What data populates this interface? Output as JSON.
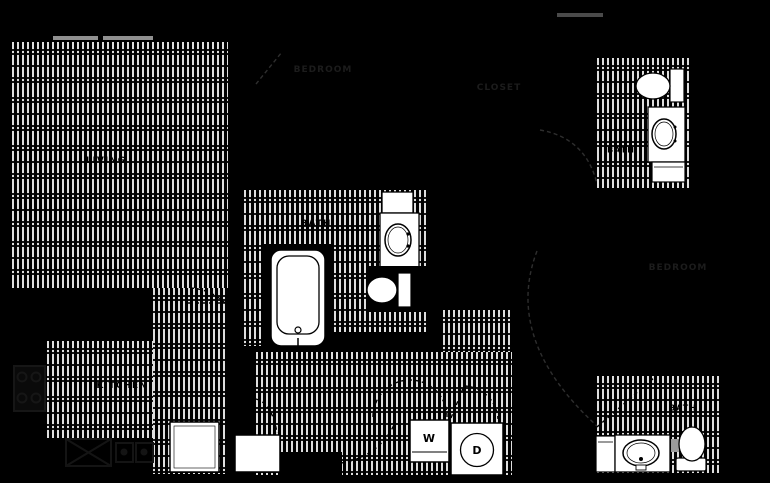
{
  "plan": {
    "title": "floor-plan",
    "rooms": {
      "living": "LIVING",
      "kitchen": "KITCHEN",
      "bath_main": "BATH",
      "bath_upper_right": "BATH",
      "bath_lower_right": "BATH",
      "bedroom_top": "BEDROOM",
      "bedroom_right": "BEDROOM",
      "closet": "CLOSET"
    },
    "appliances": {
      "washer": "W",
      "dryer": "D"
    },
    "colors": {
      "background": "#000000",
      "floor_stripe": "#dedede",
      "fixture_fill": "#ffffff",
      "fixture_outline": "#000000",
      "faint_label": "#1c1c1c",
      "faint_line": "#2e2e2e",
      "counter_icon": "#161616",
      "window_gray": "#909090"
    }
  }
}
